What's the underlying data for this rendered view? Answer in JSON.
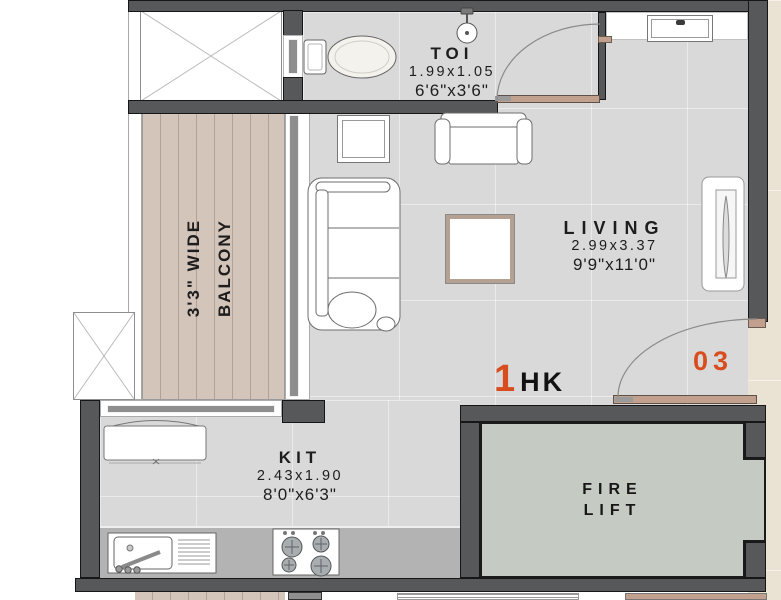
{
  "plan": {
    "unit": {
      "number": "1",
      "type": "HK",
      "flat_no": "03"
    },
    "rooms": {
      "toilet": {
        "label": "TOI",
        "dim_m": "1.99x1.05",
        "dim_ft": "6'6\"x3'6\""
      },
      "living": {
        "label": "LIVING",
        "dim_m": "2.99x3.37",
        "dim_ft": "9'9\"x11'0\""
      },
      "kitchen": {
        "label": "KIT",
        "dim_m": "2.43x1.90",
        "dim_ft": "8'0\"x6'3\""
      },
      "balcony": {
        "label_line1": "3'3\" WIDE",
        "label_line2": "BALCONY"
      },
      "fire_lift": {
        "label_line1": "FIRE",
        "label_line2": "LIFT"
      }
    },
    "fixtures": [
      "duct-shaft-x-icon",
      "toilet-wc-icon",
      "shower-icon",
      "window-icon",
      "sliding-window-icon",
      "toilet-door-swing-icon",
      "entrance-door-swing-icon",
      "sofa-icon",
      "armchair-icon",
      "coffee-table-icon",
      "side-table-icon",
      "mirror-unit-icon",
      "fridge-icon",
      "kitchen-sink-icon",
      "stove-icon",
      "kitchen-counter"
    ],
    "colors": {
      "wall": "#57585a",
      "floor": "#d9d9da",
      "balcony_floor": "#d4c5bb",
      "counter": "#b3b3b4",
      "lift_floor": "#c5cbc3",
      "exterior": "#eae3d3",
      "accent": "#d84d1e",
      "door": "#c2a08e",
      "text": "#1d1d1d"
    }
  }
}
